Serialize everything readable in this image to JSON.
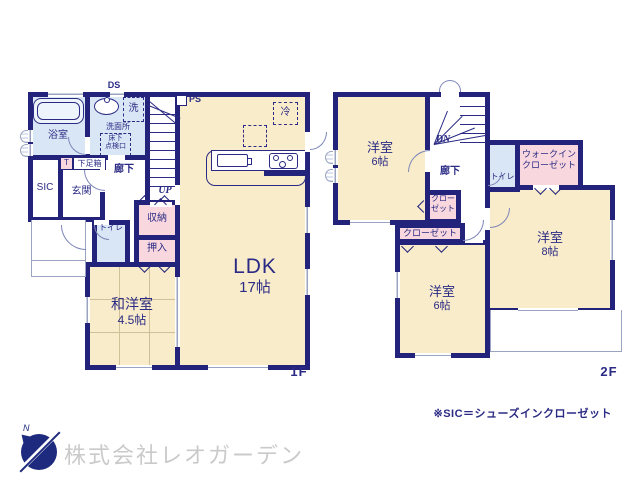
{
  "colors": {
    "wall": "#23237b",
    "room_cream": "#f9ecca",
    "wet_blue": "#d9e6f5",
    "closet_pink": "#f8d8de",
    "text_navy": "#2b2b85",
    "company_gray": "#cacaca"
  },
  "floor1": {
    "label": "1F",
    "duct": "DS",
    "pipe": "PS",
    "fridge": "冷",
    "bath": "浴室",
    "laundry": "洗",
    "washroom": "洗面所",
    "underfloor_l1": "床下",
    "underfloor_l2": "点検口",
    "sic": "SIC",
    "entrance": "玄関",
    "shoebox_t": "T",
    "shoebox": "下足箱",
    "hall": "廊下",
    "up": "UP",
    "toilet": "トイレ",
    "storage": "収納",
    "oshiire": "押入",
    "ldk": "LDK",
    "ldk_size": "17帖",
    "washitsu": "和洋室",
    "washitsu_size": "4.5帖"
  },
  "floor2": {
    "label": "2F",
    "dn": "DN",
    "hall": "廊下",
    "toilet": "トイレ",
    "bed1": "洋室",
    "bed1_size": "6帖",
    "wic_l1": "ウォークイン",
    "wic_l2": "クローゼット",
    "closet_v_l1": "クロー",
    "closet_v_l2": "ゼット",
    "closet_h": "クローゼット",
    "bed2": "洋室",
    "bed2_size": "6帖",
    "bed3": "洋室",
    "bed3_size": "8帖"
  },
  "footer": {
    "note": "※SIC＝シューズインクローゼット",
    "company": "株式会社レオガーデン",
    "compass_n": "N"
  }
}
